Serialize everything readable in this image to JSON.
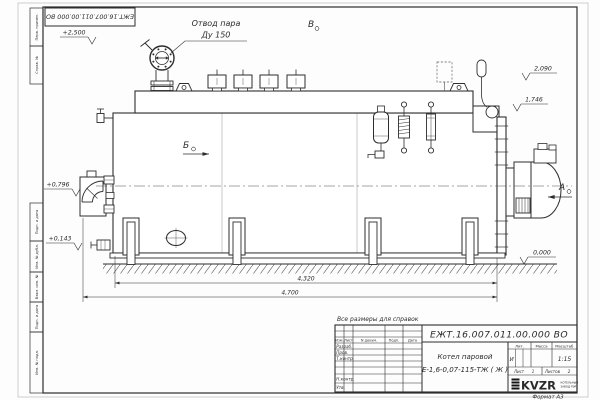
{
  "frame": {
    "stamp_top": "ЕЖТ.16.007.011.00.000  ВО",
    "margin_labels": [
      "Перв. примен.",
      "Справ. №",
      "Подп. и дата",
      "Инв. № дубл.",
      "Взам. инв. №",
      "Подп. и дата",
      "Инв. № подл."
    ],
    "format_note": "Формат А3"
  },
  "title_block": {
    "doc_number": "ЕЖТ.16.007.011.00.000  ВО",
    "note": "Все размеры для справок",
    "name_line1": "Котел паровой",
    "name_line2": "Е-1,6-0,07-115-ТЖ ( Ж )",
    "col_izm": "Изм.",
    "col_list": "Лист",
    "col_ndoc": "N докум.",
    "col_podp": "Подп.",
    "col_data": "Дата",
    "row_razrab": "Разраб.",
    "row_prov": "Пров.",
    "row_tkontr": "Т.контр.",
    "row_nkontr": "Н.контр.",
    "row_utv": "Утв.",
    "lit_header": "Лит.",
    "mass_header": "Масса",
    "scale_header": "Масштаб",
    "lit_value": "И",
    "scale_value": "1:15",
    "sheet_label": "Лист",
    "sheet_value": "1",
    "sheets_label": "Листов",
    "sheets_value": "2",
    "logo_text": "KVZR",
    "logo_sub1": "КОТЕЛЬНЫЙ",
    "logo_sub2": "ЗАВОД РЭР"
  },
  "annotations": {
    "steam_outlet_1": "Отвод пара",
    "steam_outlet_2": "Ду 150",
    "view_b": "Б",
    "view_v": "В",
    "view_a": "А",
    "elev_plus2500": "+2,500",
    "elev_2090": "2,090",
    "elev_1746": "1,746",
    "elev_plus0796": "+0,796",
    "elev_plus0143": "+0,143",
    "elev_zero": "0,000",
    "dim_length_inner": "4,320",
    "dim_length_overall": "4,700"
  }
}
